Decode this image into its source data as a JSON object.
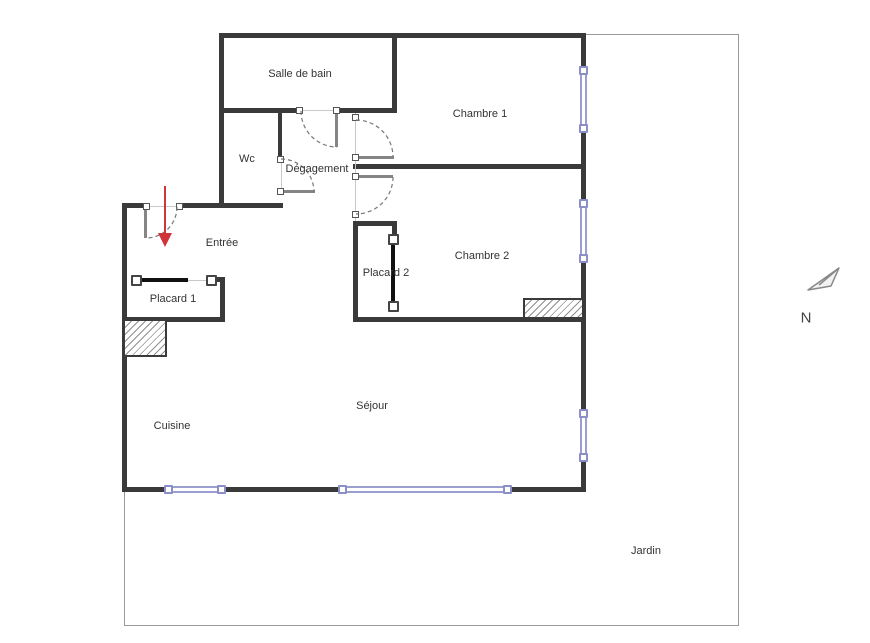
{
  "labels": {
    "salle_de_bain": "Salle de bain",
    "wc": "Wc",
    "degagement": "Dégagement",
    "chambre_1": "Chambre 1",
    "entree": "Entrée",
    "chambre_2": "Chambre 2",
    "placard_1": "Placard 1",
    "placard_2": "Placard 2",
    "cuisine": "Cuisine",
    "sejour": "Séjour",
    "jardin": "Jardin",
    "north": "N"
  },
  "colors": {
    "wall": "#3a3a3a",
    "sliding_door": "#111111",
    "door_leaf": "#858585",
    "door_arc": "#777777",
    "window": "#9a9ed0",
    "window_handle_border": "#8a8fc8",
    "entry_arrow": "#d13438",
    "garden_boundary": "#999999",
    "label_text": "#333333",
    "background": "#ffffff"
  }
}
